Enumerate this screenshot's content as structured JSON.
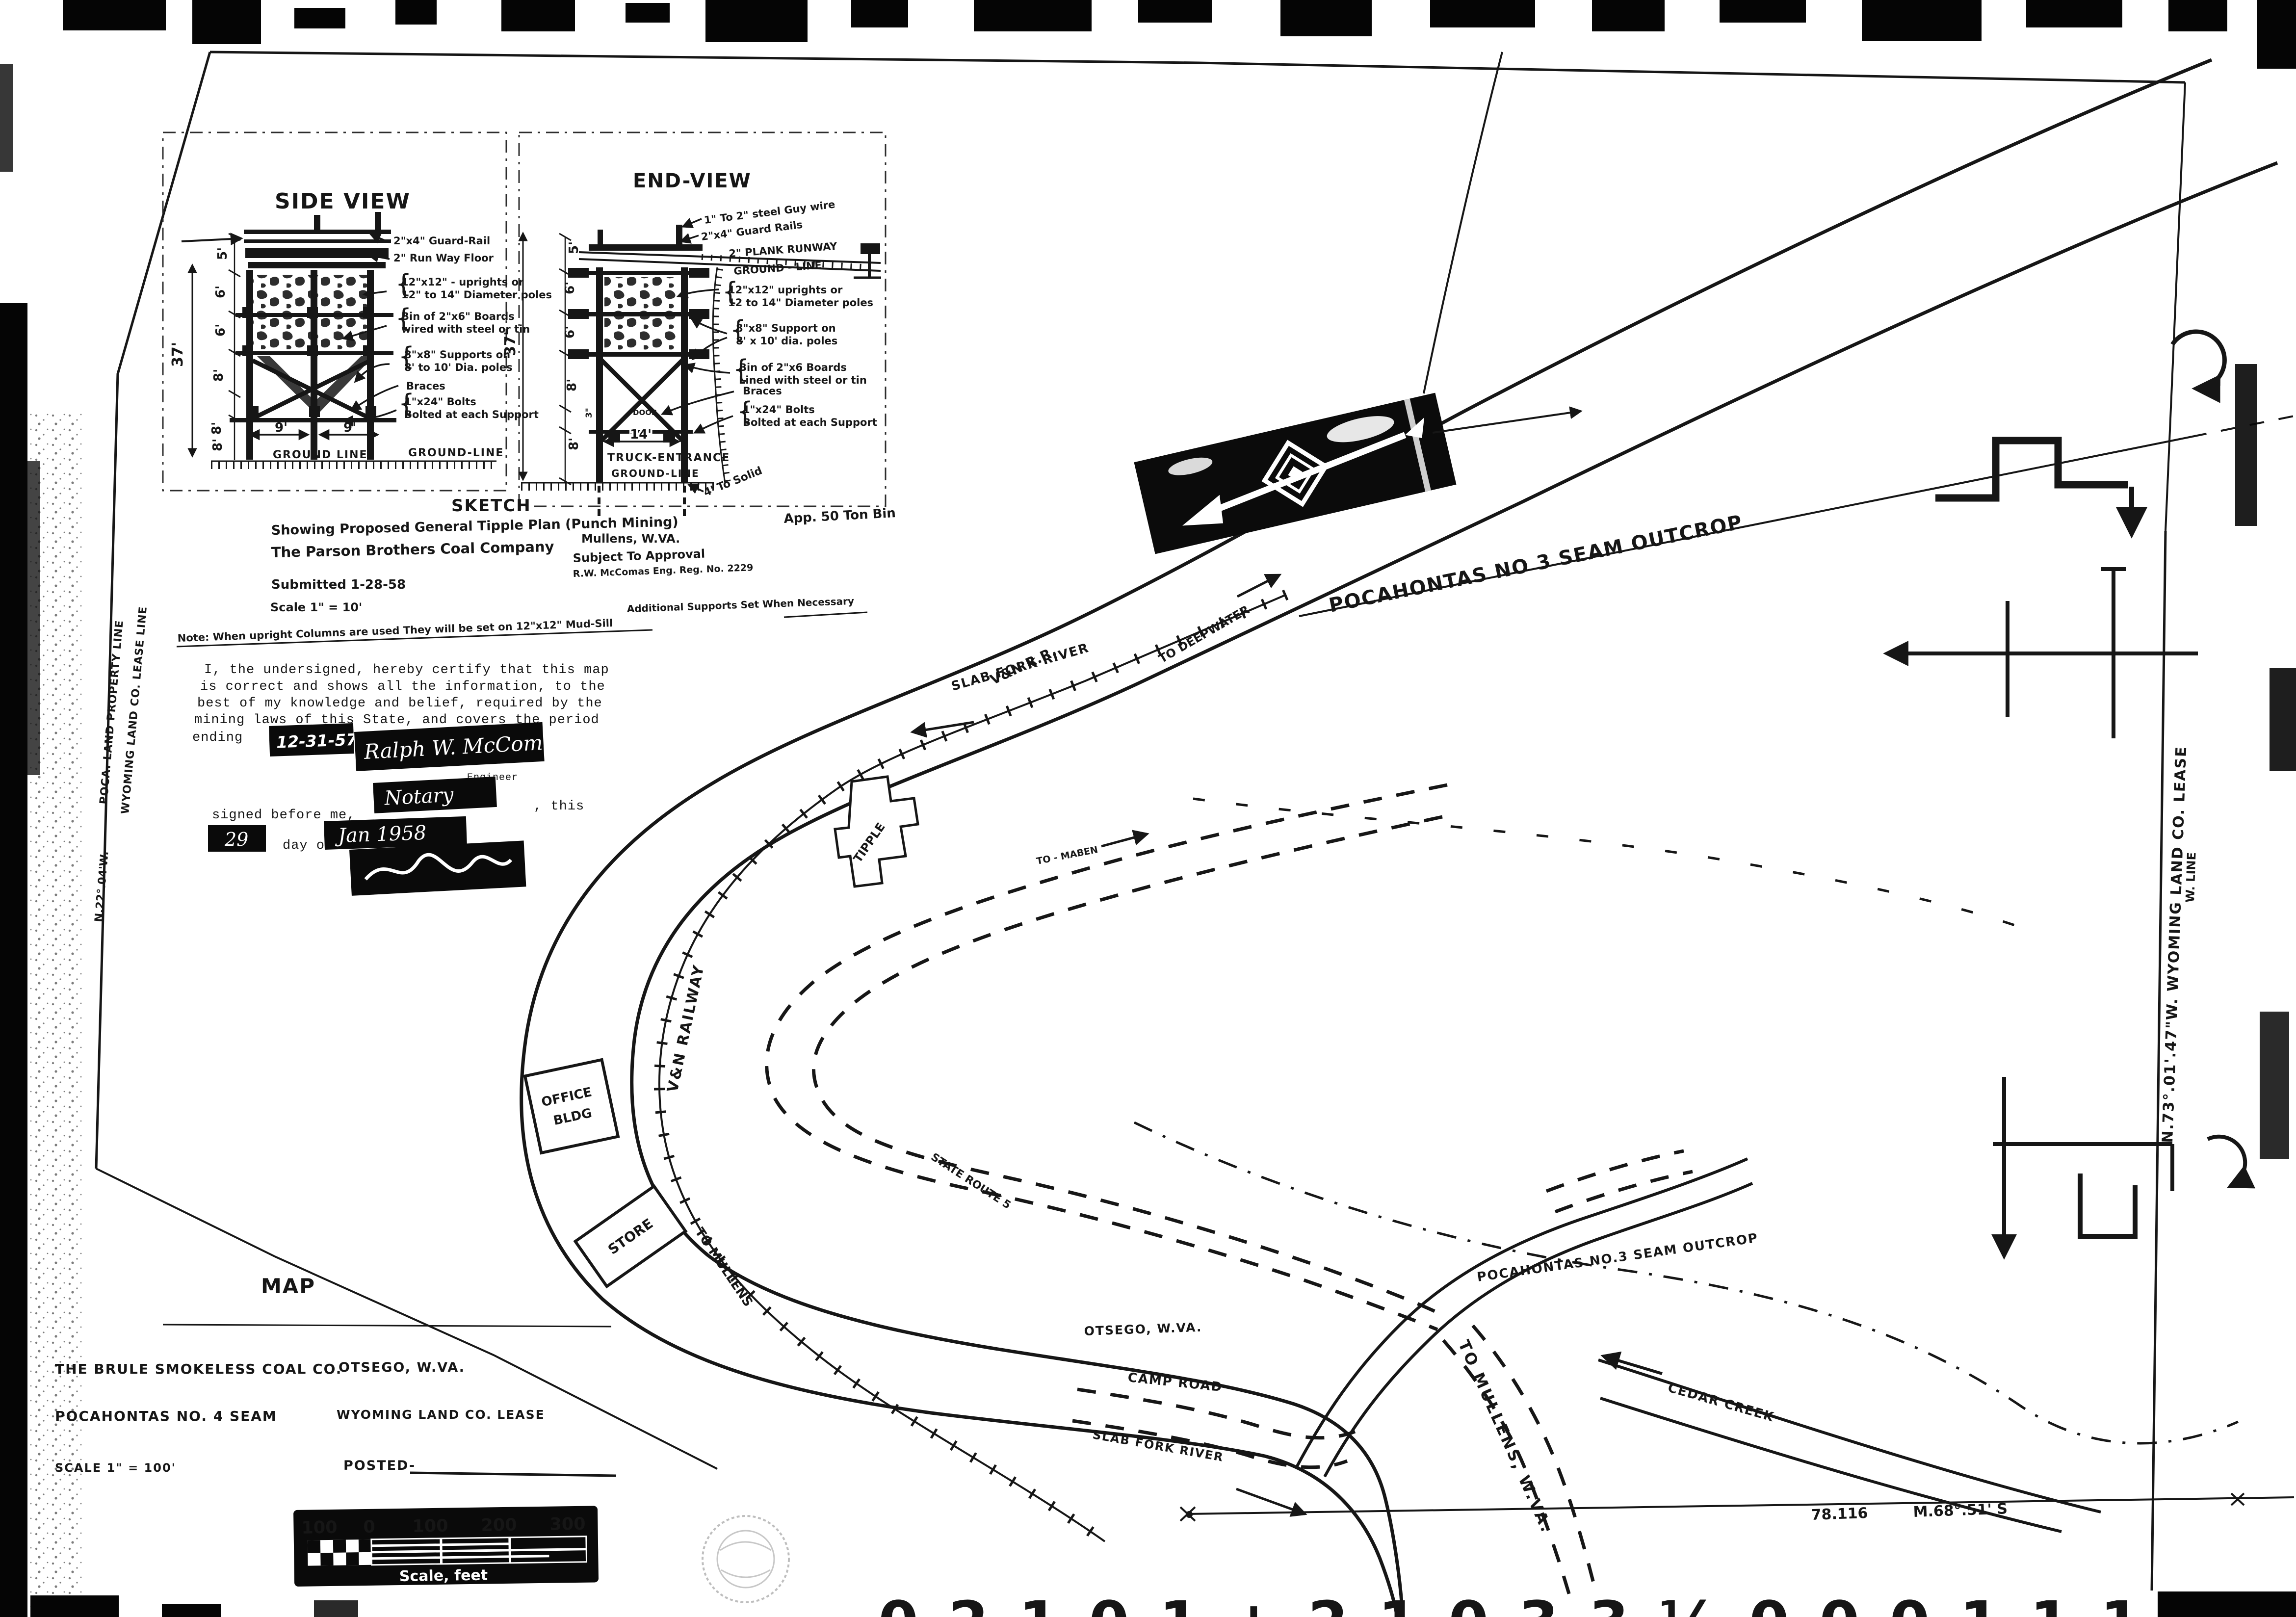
{
  "page": {
    "bg": "#ffffff",
    "ink": "#161616"
  },
  "sketch_panel": {
    "side": {
      "title": "SIDE VIEW",
      "dim_height": "37'",
      "dims": [
        "5'",
        "6'",
        "6'",
        "8'",
        "8'"
      ],
      "dim_w1": "9'",
      "dim_w2": "9'",
      "dim_base": "8'",
      "ground_left": "GROUND LINE",
      "ground_right": "GROUND-LINE",
      "ann_guard": "2\"x4\" Guard-Rail",
      "ann_runway": "2\" Run Way Floor",
      "ann_upr1": "12\"x12\" - uprights or",
      "ann_upr2": "12\" to 14\" Diameter poles",
      "ann_bin1": "Bin of 2\"x6\" Boards",
      "ann_bin2": "wired with steel or tin",
      "ann_sup1": "8\"x8\" Supports on",
      "ann_sup2": "8' to 10' Dia. poles",
      "ann_braces": "Braces",
      "ann_bolt1": "1\"x24\" Bolts",
      "ann_bolt2": "Bolted at each Support"
    },
    "end": {
      "title": "END-VIEW",
      "dim_height": "37'",
      "dims": [
        "5'",
        "6'",
        "6'",
        "8'",
        "3\"",
        "8'"
      ],
      "dim_w": "14'",
      "truck": "TRUCK-ENTRANCE",
      "ground_top": "GROUND - LINE",
      "ground_bottom": "GROUND-LINE",
      "solid": "4' To Solid",
      "bin_cap": "App. 50 Ton Bin",
      "ann_guy": "1\" To 2\" steel Guy wire",
      "ann_guard": "2\"x4\" Guard Rails",
      "ann_plank": "2\" PLANK RUNWAY",
      "ann_upr1": "12\"x12\" uprights or",
      "ann_upr2": "12 to 14\" Diameter poles",
      "ann_sup1": "8\"x8\" Support on",
      "ann_sup2": "8' x 10' dia. poles",
      "ann_bin1": "Bin of 2\"x6 Boards",
      "ann_bin2": "Lined with steel or tin",
      "ann_braces": "Braces",
      "ann_bolt1": "1\"x24\" Bolts",
      "ann_bolt2": "Bolted at each Support",
      "door": "DOOR"
    }
  },
  "sketch_block": {
    "title": "SKETCH",
    "line1": "Showing Proposed General Tipple Plan (Punch Mining)",
    "line2": "The Parson Brothers Coal Company",
    "city": "Mullens, W.VA.",
    "submitted": "Submitted 1-28-58",
    "subject": "Subject To Approval",
    "engineer": "R.W. McComas Eng. Reg. No. 2229",
    "scale": "Scale 1\" = 10'",
    "note": "Note: When upright Columns are used They will be set on 12\"x12\" Mud-Sill",
    "note2": "Additional Supports Set When Necessary"
  },
  "certification": {
    "line1": "I, the undersigned, hereby certify that this map",
    "line2": "is correct and shows all the information, to the",
    "line3": "best of my knowledge and belief, required by the",
    "line4": "mining laws of this State, and covers the period",
    "line5": "ending",
    "date": "12-31-57",
    "signature": "Ralph W. McComas",
    "engineer_label": "Engineer",
    "notary": "Notary",
    "this_label": ", this",
    "before": "signed before me,",
    "day": "29",
    "day_of": "day of",
    "month": "Jan 1958"
  },
  "map_block": {
    "title": "MAP",
    "company": "THE BRULE SMOKELESS COAL CO.",
    "place": "OTSEGO, W.VA.",
    "seam": "POCAHONTAS NO. 4 SEAM",
    "lease": "WYOMING LAND CO. LEASE",
    "scale": "SCALE 1\" = 100'",
    "posted": "POSTED-"
  },
  "map_labels": {
    "river_upper": "SLAB FORK RIVER",
    "river_lower": "SLAB FORK RIVER",
    "deepwater": "TO DEEPWATER",
    "vn_rr": "V&N R.R.",
    "vn_railway": "V&N RAILWAY",
    "tipple": "TIPPLE",
    "outcrop_upper": "POCAHONTAS NO 3 SEAM OUTCROP",
    "outcrop_lower": "POCAHONTAS NO.3 SEAM OUTCROP",
    "maben": "TO - MABEN",
    "state_route": "STATE ROUTE 5",
    "otsego": "OTSEGO, W.VA.",
    "camp_road": "CAMP ROAD",
    "mullens_road": "TO MULLENS, W.VA.",
    "mullens_rail": "TO MULLENS",
    "cedar": "CEDAR CREEK",
    "bearing_a": "78.116",
    "bearing_b": "M.68°.51' S",
    "office1": "OFFICE",
    "office2": "BLDG",
    "store": "STORE",
    "prop_line1": "POCA. LAND PROPERTY LINE",
    "prop_line2": "WYOMING LAND CO. LEASE LINE",
    "bearing_left": "N.22°.04'W.",
    "lease_right": "N.73°.01'.47\"W.   WYOMING LAND CO. LEASE",
    "lease_right2": "W. LINE"
  },
  "scale_bar": {
    "t0": "100",
    "t1": "0",
    "t2": "100",
    "t3": "200",
    "t4": "300",
    "caption": "Scale, feet"
  },
  "film_footer": {
    "digits": "0 2 1 0 1 +    2 1 0   3 3 ½    0 0 0 1 1 1"
  }
}
